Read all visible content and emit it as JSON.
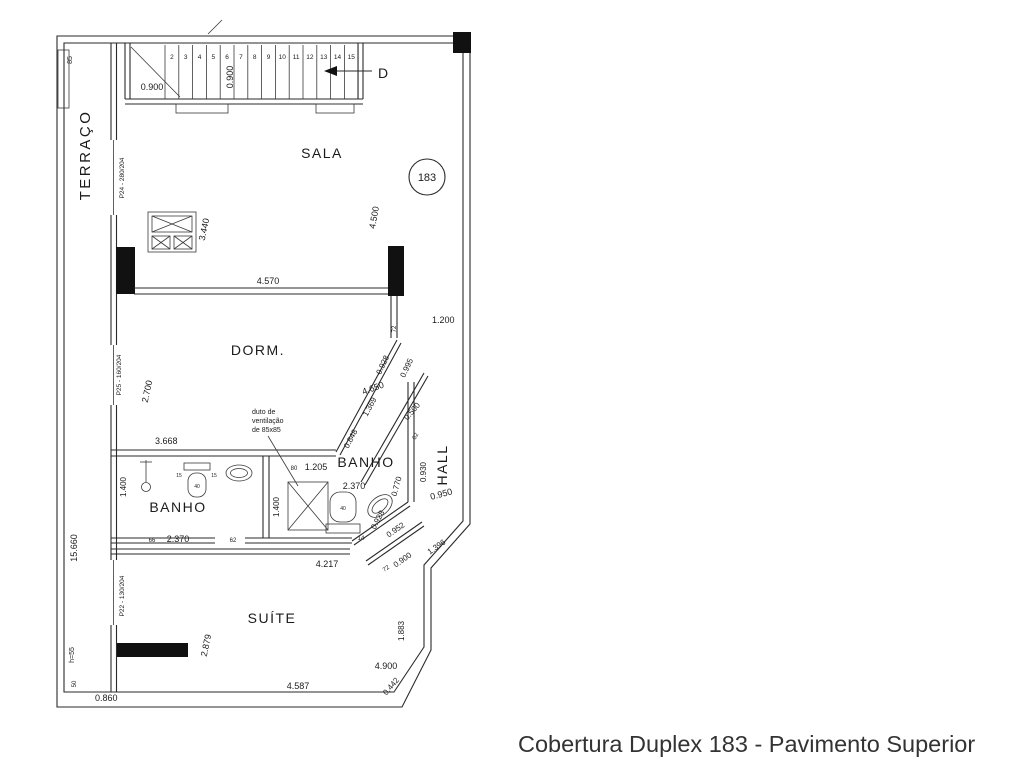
{
  "caption": "Cobertura Duplex 183 - Pavimento Superior",
  "unit_number": "183",
  "rooms": {
    "terraco": "TERRAÇO",
    "sala": "SALA",
    "dorm": "DORM.",
    "banho1": "BANHO",
    "banho2": "BANHO",
    "hall": "HALL",
    "suite": "SUÍTE"
  },
  "stairs": {
    "numbers": [
      "2",
      "3",
      "4",
      "5",
      "6",
      "7",
      "8",
      "9",
      "10",
      "11",
      "12",
      "13",
      "14",
      "15"
    ],
    "dim_start": "0.900",
    "dim_mid": "0.900",
    "direction_label": "D"
  },
  "doors": {
    "p24": "P24 - 280/204",
    "p25": "P25 - 160/204",
    "p22": "P22 - 130/204"
  },
  "vent_note": {
    "line1": "duto de",
    "line2": "ventilação",
    "line3": "de 85x85"
  },
  "dims": {
    "sala_width": "4.570",
    "sala_depth": "4.500",
    "sala_shaft": "3.440",
    "dorm_depth": "2.700",
    "dorm_width": "3.668",
    "right_gap": "1.200",
    "diag_0928": "0.928",
    "diag_0995": "0.995",
    "diag_4650": "4.650",
    "diag_1369": "1.369",
    "diag_0848": "0.848",
    "diag_0500": "0.500",
    "hall_0930": "0.930",
    "hall_0950": "0.950",
    "banho2_0770": "0.770",
    "banho2_0928": "0.928",
    "banho1_height": "1.400",
    "banho1_width": "2.370",
    "banho2_height": "1.400",
    "banho2_width": "2.370",
    "banho2_1205": "1.205",
    "se_0952": "0.952",
    "se_0900": "0.900",
    "se_1396": "1.396",
    "suite_top": "4.217",
    "suite_diag": "2.879",
    "suite_1883": "1.883",
    "suite_4900": "4.900",
    "suite_0442": "0.442",
    "suite_width": "4.587",
    "terraco_height": "15.660",
    "terraco_width": "0.860"
  },
  "small_marks": {
    "n85": "85",
    "h55": "h=55",
    "n50": "50",
    "n72a": "72",
    "n72b": "72",
    "n62a": "62",
    "n62b": "62",
    "n66": "66",
    "n80": "80",
    "n15a": "15",
    "n15b": "15",
    "n40a": "40",
    "n40b": "40",
    "n14": "14"
  }
}
